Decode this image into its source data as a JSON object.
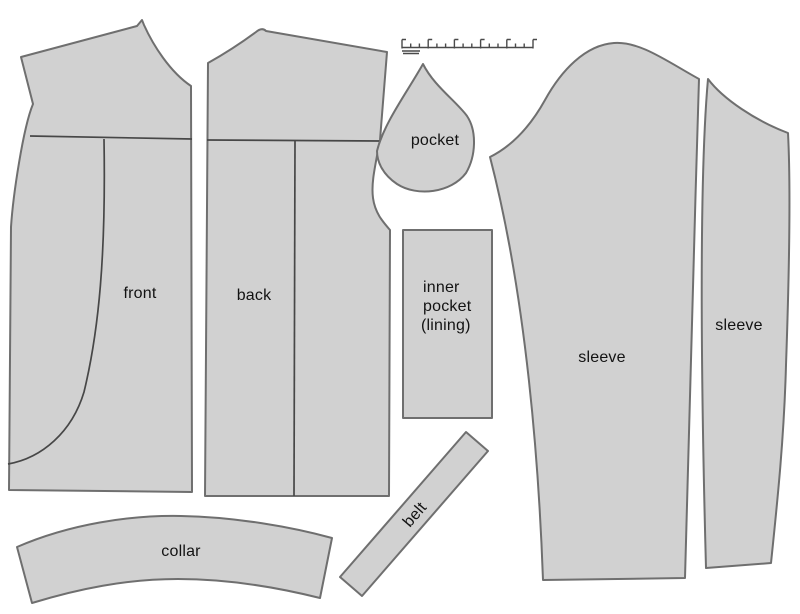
{
  "title": "Garment sewing pattern layout diagram",
  "canvas": {
    "width": 800,
    "height": 614,
    "background": "#ffffff"
  },
  "colors": {
    "piece_fill": "#d1d1d1",
    "piece_outline": "#6f6f6f",
    "interior_line": "#474747",
    "ruler_line": "#4a4a4a",
    "label_text": "#131313"
  },
  "pieces": [
    {
      "id": "front",
      "label": "front"
    },
    {
      "id": "back",
      "label": "back"
    },
    {
      "id": "pocket",
      "label": "pocket"
    },
    {
      "id": "inner-pocket-lining",
      "label_lines": [
        "inner",
        "pocket",
        "(lining)"
      ]
    },
    {
      "id": "sleeve-upper",
      "label": "sleeve"
    },
    {
      "id": "sleeve-under",
      "label": "sleeve"
    },
    {
      "id": "collar",
      "label": "collar"
    },
    {
      "id": "belt",
      "label": "belt"
    }
  ]
}
